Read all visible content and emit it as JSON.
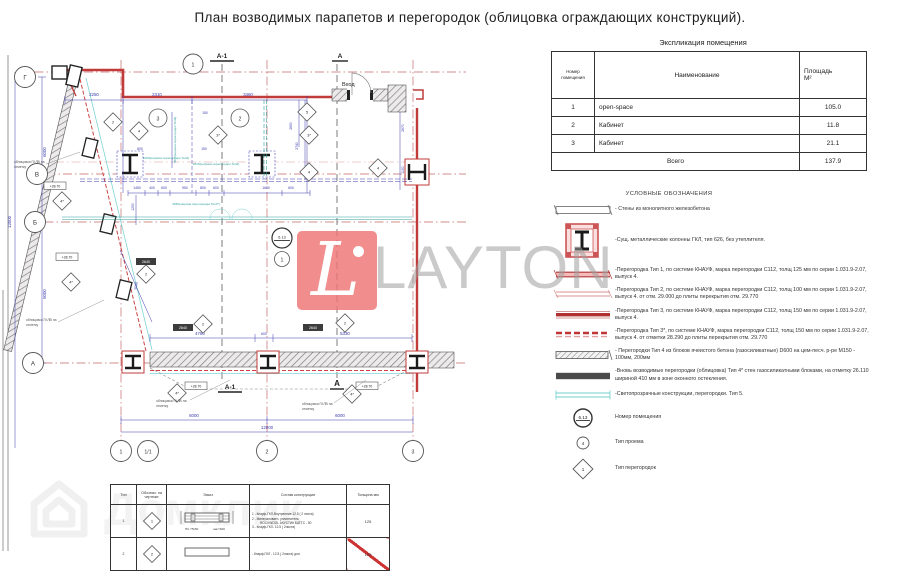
{
  "title": "План возводимых парапетов и перегородок (облицовка ограждающих конструкций).",
  "explication": {
    "title": "Экспликация помещения",
    "col_number_l1": "Номер",
    "col_number_l2": "помещения",
    "col_name": "Наименование",
    "col_area_l1": "Площадь",
    "col_area_l2": "М²",
    "rows": [
      {
        "num": "1",
        "name": "open-space",
        "area": "105.0"
      },
      {
        "num": "2",
        "name": "Кабинет",
        "area": "11.8"
      },
      {
        "num": "3",
        "name": "Кабинет",
        "area": "21.1"
      }
    ],
    "total_label": "Всего",
    "total_value": "137.9"
  },
  "legend": {
    "heading": "УСЛОВНЫЕ ОБОЗНАЧЕНИЯ",
    "items": [
      {
        "text": "- Стены из монолитного железобетона"
      },
      {
        "text": "-Сущ. металлические колонны ГКЛ, тип 626, без утеплителя."
      },
      {
        "text": "-Перегородка Тип 1, по системе КНАУФ, марка перегородки  С112, толщ 125 мм по серии 1.031.9-2.07, выпуск 4."
      },
      {
        "text": "-Перегородка Тип 2, по системе КНАУФ, марка перегородки  С112, толщ 100 мм по серии 1.031.9-2.07, выпуск 4. от отм. 29.000 до плиты перекрытия отм. 29.770"
      },
      {
        "text": "-Перегородка Тип 3, по системе КНАУФ, марка перегородки  С112, толщ 150 мм по серии 1.031.9-2.07, выпуск 4."
      },
      {
        "text": "-Перегородка Тип 3*, по системе КНАУФ, марка перегородки  С112, толщ 150 мм по серии 1.031.9-2.07, выпуск 4. от отметки 28.290 до плиты перекрытия отм. 29.770"
      },
      {
        "text": "- Перегородки Тип 4 из блоков ячеистого бетона (газосиликатные) D600 на цем-песч. р-ре М150 - 100мм, 200мм"
      },
      {
        "text": "-Вновь возводимые перегородки (облицовка) Тип 4* стен газосиликатными блоками, на отметку 26.110 шириной 410 мм в зоне оконного остекления."
      },
      {
        "text": "-Светопрозрачные конструкции, перегородки. Тип 5."
      },
      {
        "tag": "6.13",
        "text": "Номер помещения"
      },
      {
        "tag": "4",
        "text": "Тип проема"
      },
      {
        "tag": "1",
        "text": "Тип перегородок"
      }
    ]
  },
  "watermark": {
    "letter": "L",
    "name": "LAYTON"
  },
  "watermark2": {
    "name": "Домклик"
  },
  "plan": {
    "entrance": "Вход",
    "axis_letters": [
      "Г",
      "В",
      "Б",
      "А"
    ],
    "axis_numbers": [
      "1",
      "1/1",
      "2",
      "3"
    ],
    "grid_top": "1",
    "sections": [
      "А-1",
      "А"
    ],
    "rooms": [
      "3",
      "2",
      "1"
    ],
    "room_tag": "6.13",
    "elev": "+28.70",
    "box2640": "2640",
    "ann1": "облицовка ГКЛВ на",
    "ann2": "отметку",
    "diamonds": [
      "2",
      "4",
      "3*",
      "5",
      "3*",
      "4",
      "4*",
      "4*",
      "2",
      "2",
      "2",
      "4*",
      "4*",
      "4"
    ],
    "dims": {
      "d2250": "2250",
      "d2310": "2310",
      "d3460": "3460",
      "d150": "150",
      "d800": "800",
      "d3570": "3570(ширина перегородки Тип3)",
      "d1600n": "1600(ширина перегородки Тип2)",
      "d2810n": "2810(ширина перегородки Тип2)",
      "d4560n": "4560(ширина перегородки Тип3*)",
      "d2650": "2650",
      "d2740": "2740",
      "d2670": "2670",
      "d1150": "1150",
      "d1450": "1450",
      "d400": "400",
      "d600": "600",
      "d950": "950",
      "d1600": "1600",
      "d1250": "1250",
      "d5030": "5030",
      "d4780": "4780",
      "d5330": "5330",
      "d6000": "6000",
      "d12000": "12000"
    }
  },
  "spec_table": {
    "headers": [
      "Тип",
      "Обознач. на чертеже",
      "Эскиз",
      "Состав конструкции",
      "Толщина мм"
    ],
    "row1": {
      "type": "1",
      "mark": "1",
      "comp1": "1 - Кнауф-ГКЛ-Внутренние 12.5 ( 2 листа)",
      "comp2": "2 - Минераловатн. уплотнитель",
      "comp3": "ROCKWOOL АКУСТИК БАТТС - 50",
      "comp4": "3 - Кнауф-ГКЛ- 12.5 ( 2листа)",
      "thickness": "125",
      "sk1": "ПС 75х50",
      "sk2": "шаг=600"
    },
    "row2": {
      "type": "2",
      "mark": "2",
      "comp1": "- Кнауф-ГКЛ     - 12.5 ( 2листа) для",
      "thickness": "100"
    }
  }
}
